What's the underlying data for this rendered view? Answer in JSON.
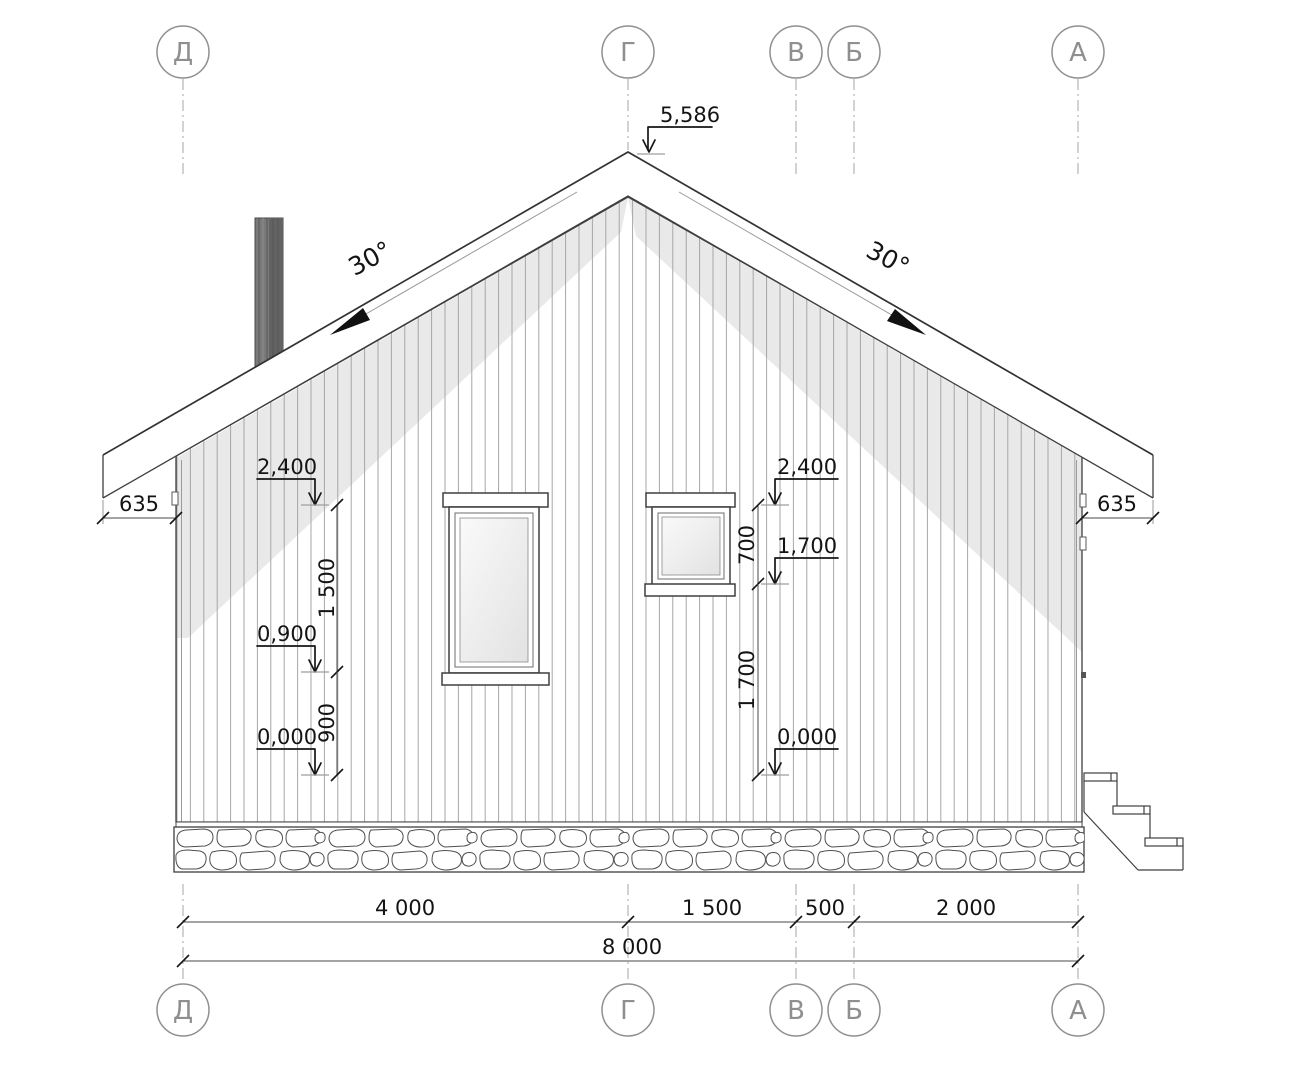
{
  "drawing_type": "house facade elevation drawing",
  "axes": {
    "labels": [
      "Д",
      "Г",
      "В",
      "Б",
      "А"
    ]
  },
  "roof": {
    "slope_left": "30°",
    "slope_right": "30°",
    "peak_elevation": "5,586"
  },
  "elevation_marks": {
    "left": [
      "2,400",
      "0,900",
      "0,000"
    ],
    "right": [
      "2,400",
      "1,700",
      "0,000"
    ]
  },
  "vertical_dims": {
    "left_upper": "1 500",
    "left_lower": "900",
    "right_upper": "700",
    "right_lower": "1 700"
  },
  "horizontal_dims": {
    "overhang_left": "635",
    "overhang_right": "635",
    "spans": [
      "4 000",
      "1 500",
      "500",
      "2 000"
    ],
    "total": "8 000"
  },
  "colors": {
    "line": "#3f3f3f",
    "thin_line": "#9a9a9a",
    "shadow": "#e9e9e9",
    "axis": "#8f8f8f",
    "chimney": "#787878",
    "text": "#141414"
  }
}
